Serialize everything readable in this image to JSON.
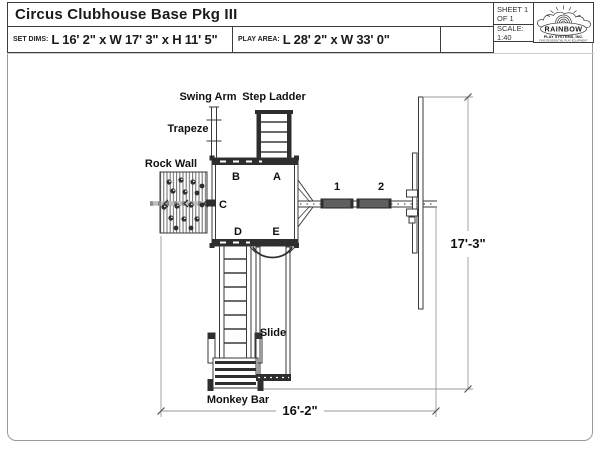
{
  "title_block": {
    "title": "Circus Clubhouse Base Pkg III",
    "sheet": "SHEET 1 OF 1",
    "scale": "SCALE: 1:40",
    "set_dims": {
      "label": "SET DIMS:",
      "value": "L 16' 2\" x W 17' 3\" x H 11' 5\""
    },
    "play_area": {
      "label": "PLAY AREA:",
      "value": "L 28' 2\" x W 33' 0\""
    },
    "logo": {
      "name": "RAINBOW",
      "line2": "PLAY SYSTEMS, INC.",
      "line3": "FINE RESIDENTIAL PLAY EQUIPMENT"
    }
  },
  "drawing": {
    "labels": {
      "swing_arm": "Swing Arm",
      "step_ladder": "Step Ladder",
      "trapeze": "Trapeze",
      "rock_wall": "Rock Wall",
      "slide": "Slide",
      "monkey_bar": "Monkey Bar"
    },
    "deck_markers": [
      {
        "label": "A"
      },
      {
        "label": "B"
      },
      {
        "label": "C"
      },
      {
        "label": "D"
      },
      {
        "label": "E"
      }
    ],
    "swing_markers": [
      {
        "label": "1"
      },
      {
        "label": "2"
      }
    ],
    "dimensions": {
      "height": "17'-3\"",
      "width": "16'-2\""
    },
    "colors": {
      "line": "#3a3a3a",
      "dark_fill": "#2e2e2e",
      "dim_line": "#8f8f8f"
    }
  }
}
